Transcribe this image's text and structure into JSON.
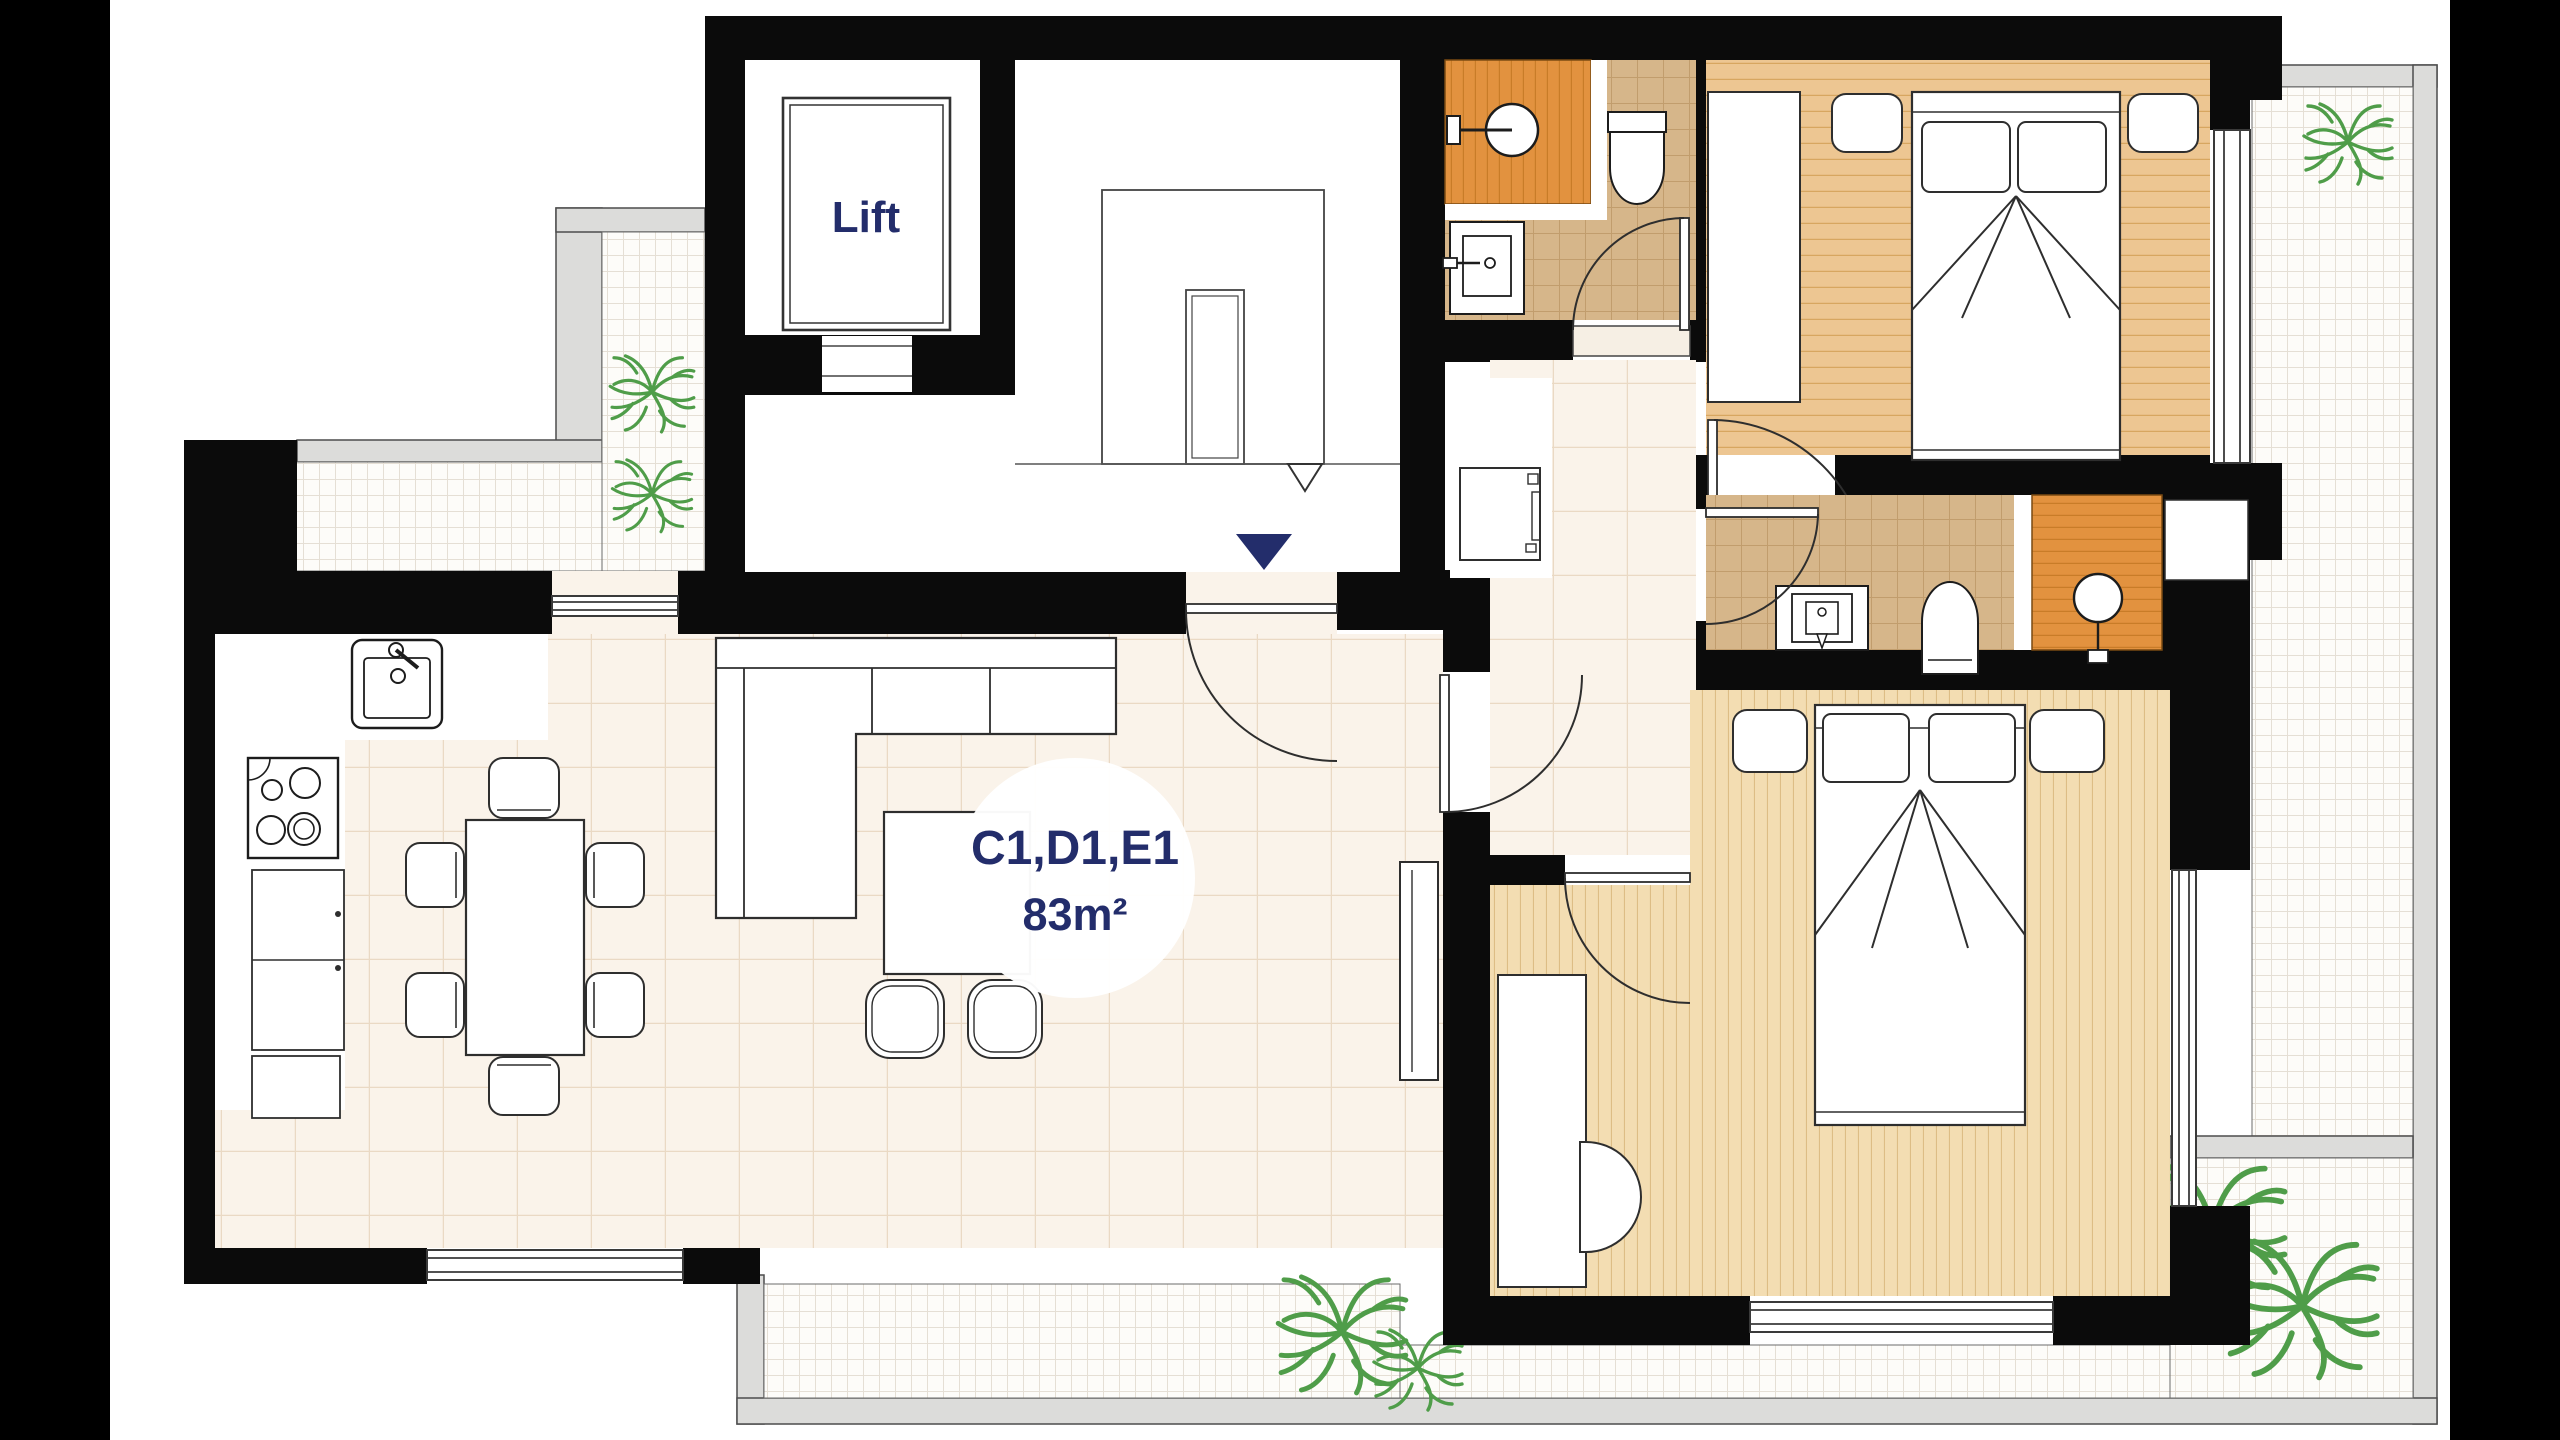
{
  "plan": {
    "lift_label": "Lift",
    "unit_label": "C1,D1,E1",
    "area_label": "83m²"
  },
  "palette": {
    "letterbox": "#000000",
    "wall": "#0b0b0b",
    "navy_text": "#232d6b",
    "cream_floor": "#faf3ea",
    "cream_grid": "#ead9c4",
    "tan_floor": "#d6b68a",
    "tan_grid": "#c19d6d",
    "shower_orange": "#e2923f",
    "shower_line": "#c87c28",
    "wood_floor": "#edc692",
    "wood_line": "#d7a660",
    "wood_light_floor": "#f3ddb2",
    "wood_light_line": "#ddbd85",
    "terrace_tile": "#fdfcf9",
    "terrace_grid": "#e5dfd5",
    "terrace_border": "#dcdcda",
    "tree_green": "#4f9d49",
    "furniture_fill": "#ffffff",
    "outline": "#2e2e2e"
  },
  "rooms": [
    {
      "name": "lift",
      "floor": "white"
    },
    {
      "name": "stairwell",
      "floor": "white"
    },
    {
      "name": "living-kitchen-dining",
      "floor": "cream-tile"
    },
    {
      "name": "hallway",
      "floor": "cream-tile"
    },
    {
      "name": "bathroom-1",
      "floor": "tan-tile-orange-shower"
    },
    {
      "name": "bedroom-1",
      "floor": "wood-horizontal"
    },
    {
      "name": "bathroom-2",
      "floor": "tan-tile-orange-shower"
    },
    {
      "name": "bedroom-2",
      "floor": "wood-vertical"
    },
    {
      "name": "terrace-top-left",
      "floor": "white-grid"
    },
    {
      "name": "terrace-right",
      "floor": "white-grid"
    },
    {
      "name": "terrace-bottom",
      "floor": "white-grid"
    }
  ],
  "furniture": [
    "lift-cab",
    "stair-flight",
    "sofa",
    "coffee-table",
    "pouf",
    "pouf",
    "tv-console",
    "dining-table",
    "dining-chair x6",
    "kitchen-sink",
    "stove",
    "kitchen-cabinets",
    "double-bed",
    "nightstand",
    "nightstand",
    "wardrobe",
    "toilet",
    "washbasin",
    "shower-head",
    "double-bed",
    "nightstand",
    "nightstand",
    "desk",
    "desk-chair",
    "toilet",
    "washbasin",
    "shower-head",
    "washer-column",
    "closet"
  ],
  "trees": [
    {
      "x": 652,
      "y": 392,
      "s": 0.95
    },
    {
      "x": 652,
      "y": 494,
      "s": 0.9
    },
    {
      "x": 2348,
      "y": 142,
      "s": 1.0
    },
    {
      "x": 1342,
      "y": 1332,
      "s": 1.45
    },
    {
      "x": 1418,
      "y": 1368,
      "s": 1.0
    },
    {
      "x": 2212,
      "y": 1228,
      "s": 1.65
    },
    {
      "x": 2302,
      "y": 1306,
      "s": 1.7
    }
  ]
}
